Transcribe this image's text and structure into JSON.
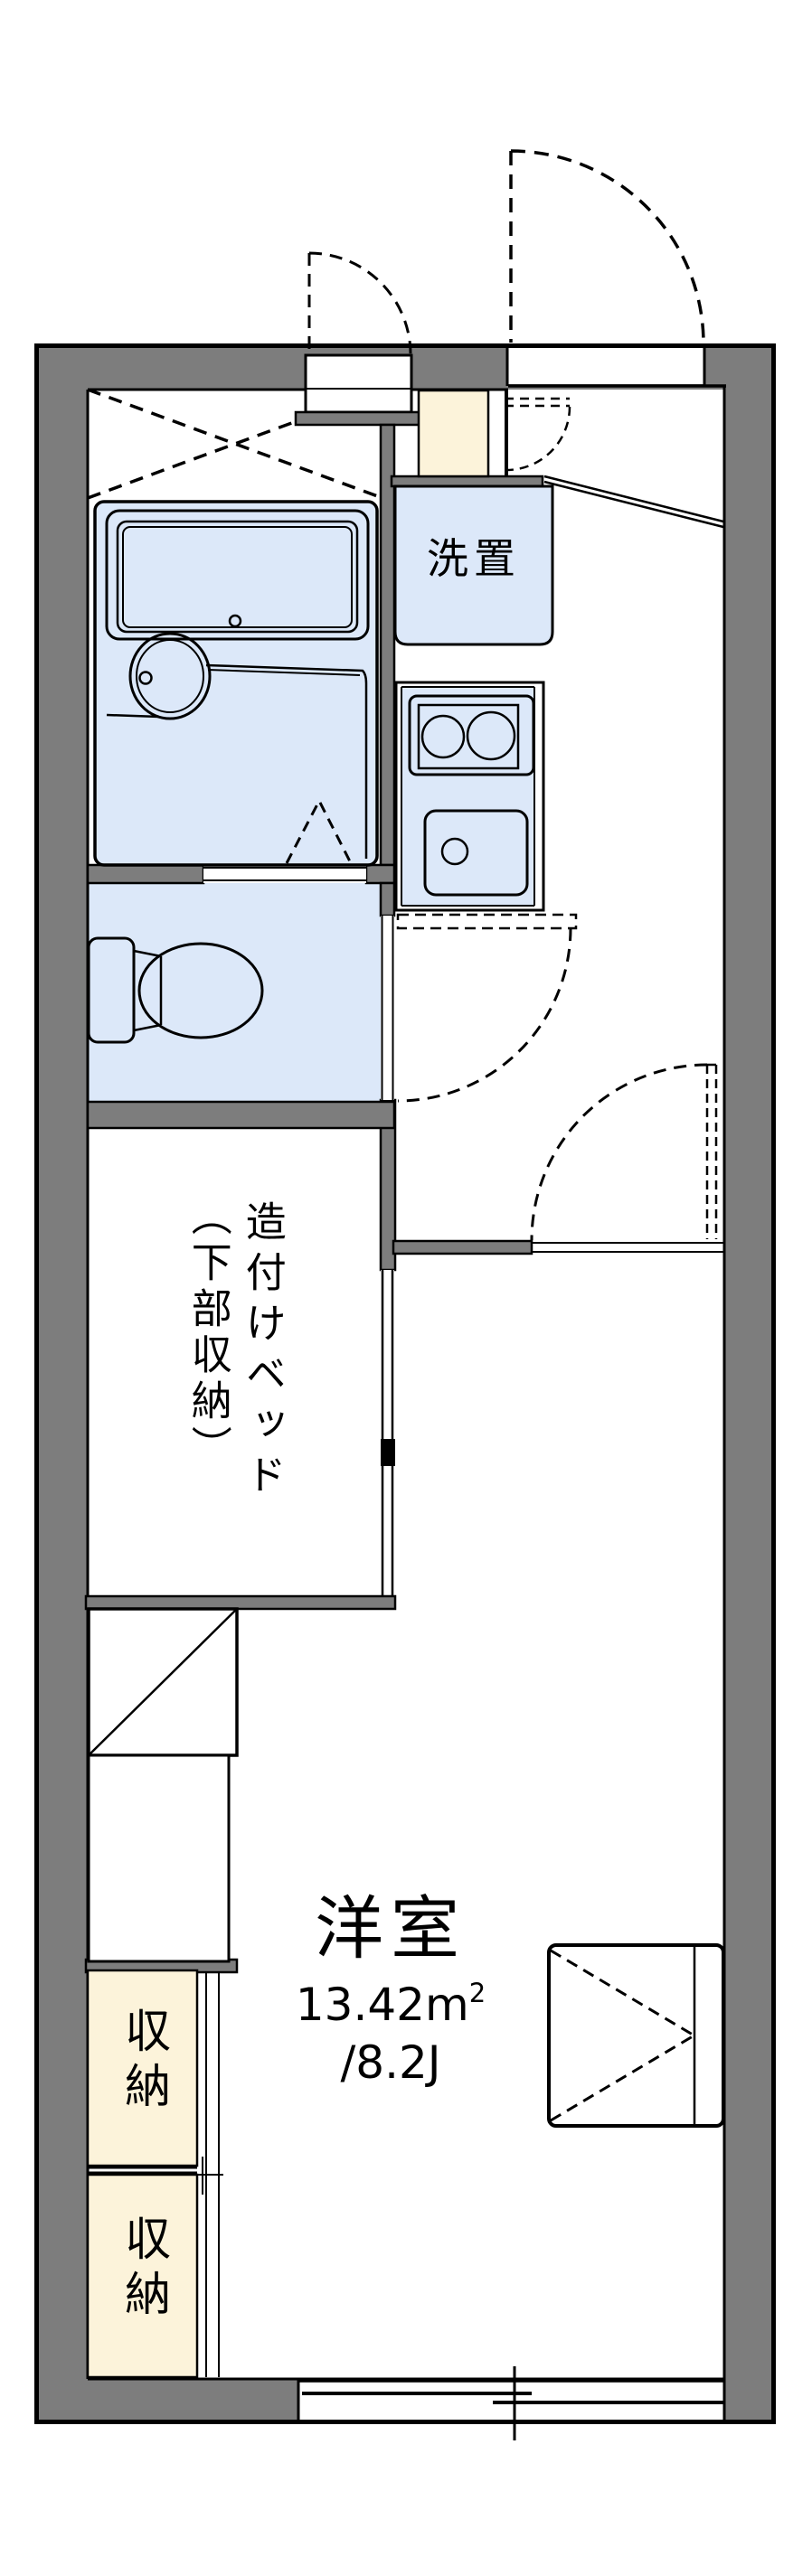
{
  "plan": {
    "title": "apartment-floorplan",
    "labels": {
      "laundry": "洗置",
      "builtin_bed_line1": "造付けベッド",
      "builtin_bed_line2": "（下部収納）",
      "storage_upper": "収納",
      "storage_lower": "収納",
      "room_name": "洋室",
      "room_area_value": "13.42m",
      "room_area_sup": "2",
      "room_area_tatami": "/8.2J"
    },
    "colors": {
      "wall": "#7d7d7d",
      "fixture": "#dce8f9",
      "storage": "#fcf3da",
      "line": "#000000"
    }
  }
}
